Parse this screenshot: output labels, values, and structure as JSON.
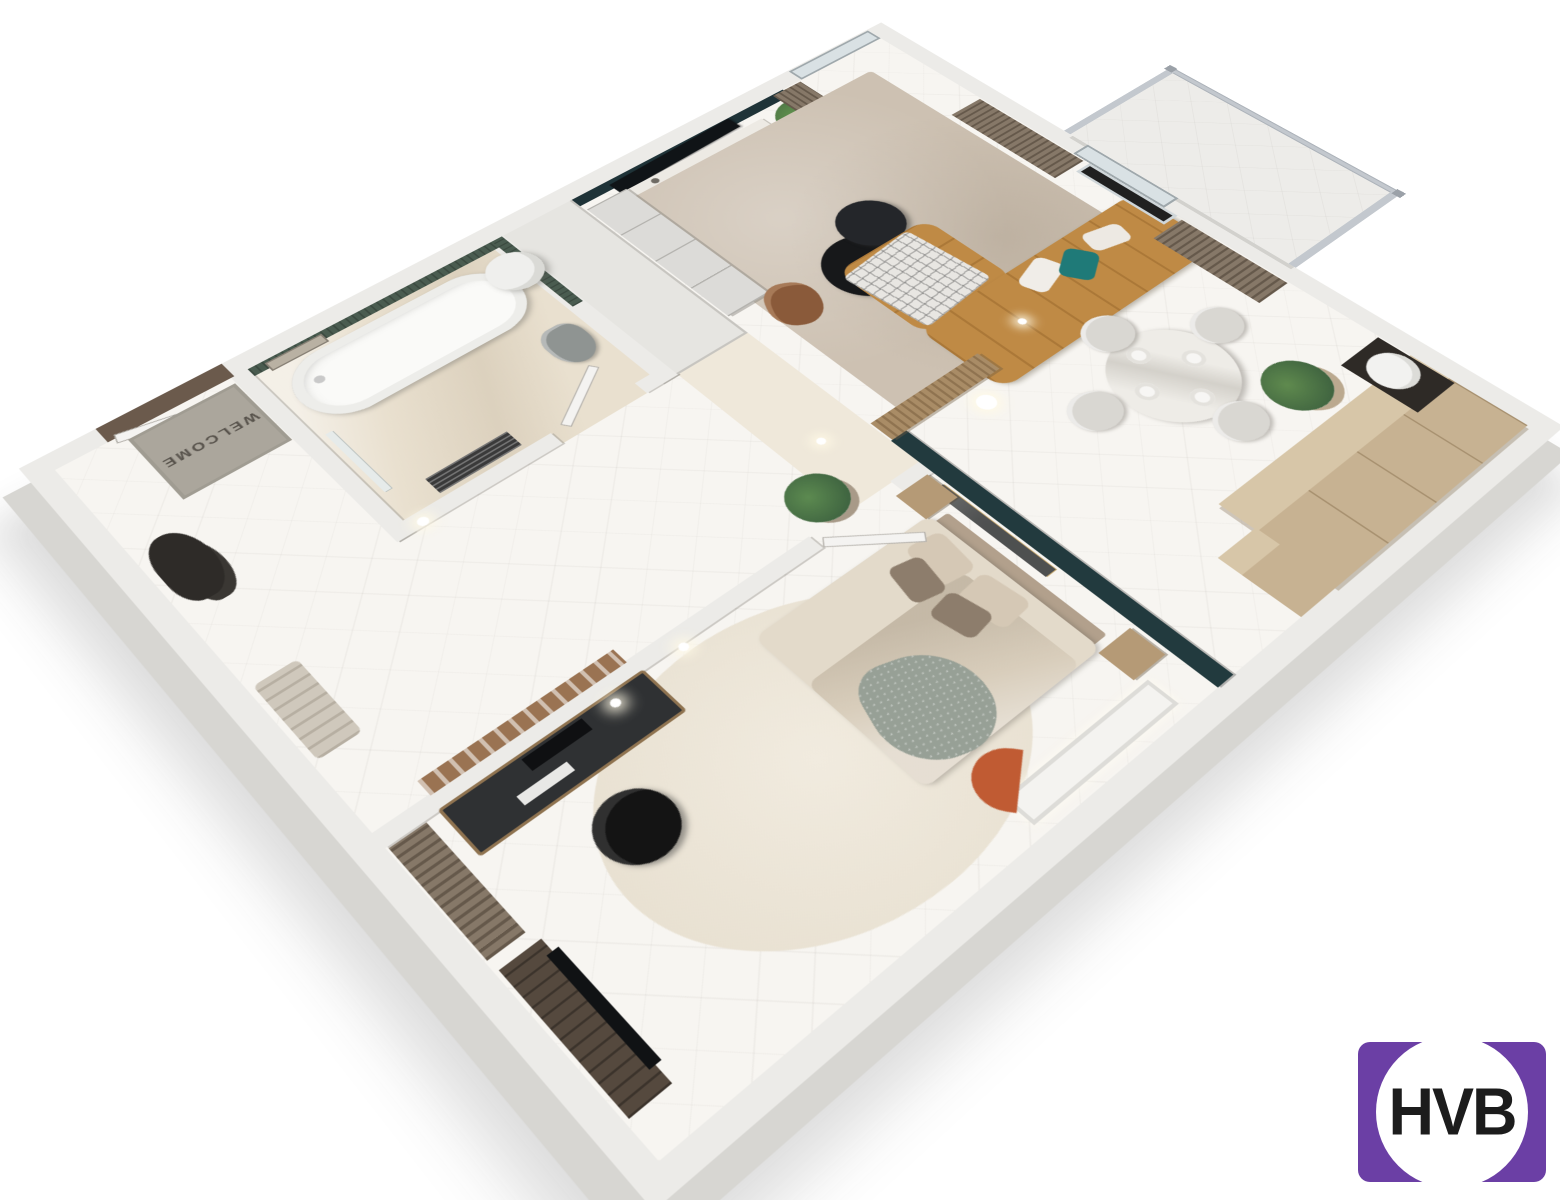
{
  "scene": {
    "type": "isometric-3d-floor-plan-render",
    "rooms": [
      "hallway",
      "bathroom",
      "bedroom-with-office",
      "living-dining",
      "balcony"
    ]
  },
  "texts": {
    "welcome_mat": "WELCOME",
    "logo": "HVB"
  },
  "palette": {
    "wall": "#ECEBE8",
    "wall-side": "#D7D6D2",
    "wall-dark": "#C9C8C4",
    "floor": "#F7F5F1",
    "bath-floor": "#E9E0CF",
    "corridor-floor": "#EFE8DA",
    "teal": "#223A3E",
    "tv-wall": "#1F3338",
    "bath-green": "#4A5C50",
    "sofa": "#BF8A45",
    "sofa-line": "#A97839",
    "rug": "#CDC1B2",
    "bed-rug": "#EFE9DC",
    "wood": "#C7B292",
    "wood-top": "#D7C6A8",
    "wood-dark": "#8F7350",
    "curtain": "#867868",
    "curtain-dark": "#6E6155",
    "plant": "#4C7042",
    "plant-dark": "#35573B",
    "pot": "#A89A88",
    "terracotta": "#C05B33",
    "black": "#17181A",
    "marble": "#EDEAE4",
    "glass": "#D9E1E4",
    "metal": "#C3C8CE",
    "mat": "#ABA69C",
    "mat-text": "#57524B",
    "door-wood": "#6B5A4C",
    "white-door": "#F4F3F1",
    "duvet": "#D8CDBB",
    "sheet": "#E3DACA",
    "pillow-dark": "#8D7D6C",
    "pillow-light": "#D5C8B5",
    "headboard": "#B2A08C",
    "chair-black": "#141414",
    "desk": "#2F3133",
    "pinboard": "#9A7352",
    "toilet": "#8F9492",
    "radiator": "#3A3A3A",
    "console-dark": "#55493E",
    "throw-green": "#97A096",
    "plaid": "#E8E6E2",
    "dining-chair": "#D9D7D2",
    "teal-pillow": "#1F7A78",
    "logo-purple": "#6B3FA5",
    "logo-text": "#1C1C1C"
  }
}
